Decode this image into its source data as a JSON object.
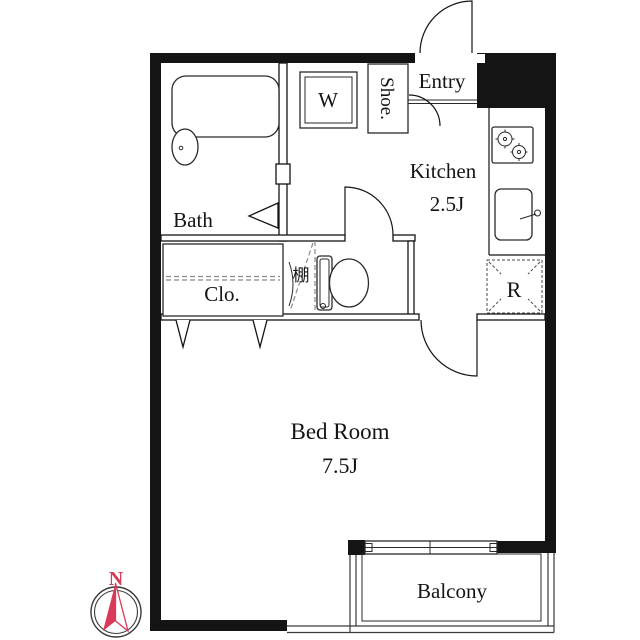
{
  "rooms": {
    "bath": {
      "label": "Bath"
    },
    "kitchen": {
      "label": "Kitchen",
      "size": "2.5J"
    },
    "bed_room": {
      "label": "Bed Room",
      "size": "7.5J"
    },
    "closet": {
      "label": "Clo."
    },
    "entry": {
      "label": "Entry"
    },
    "balcony": {
      "label": "Balcony"
    }
  },
  "fixtures": {
    "washing_machine": {
      "label": "W"
    },
    "shoe_cabinet": {
      "label": "Shoe."
    },
    "refrigerator": {
      "label": "R"
    },
    "shelf": {
      "label": "棚"
    }
  },
  "compass": {
    "north": "N",
    "needle_color": "#d93a58",
    "wall_color": "#141414"
  }
}
